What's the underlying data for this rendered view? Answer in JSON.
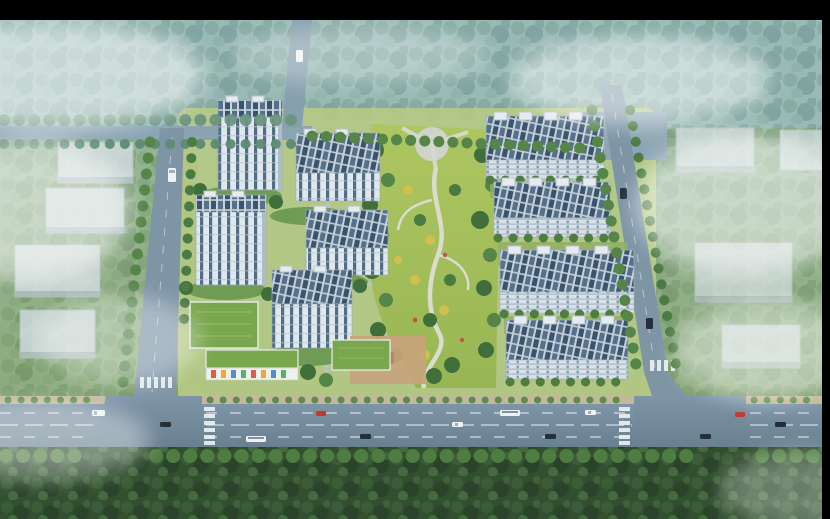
{
  "meta": {
    "subject": "Aerial architectural rendering of a residential community master plan",
    "view": "bird's-eye perspective with atmospheric fog, no text or UI elements",
    "canvas": {
      "width": 830,
      "height": 519
    },
    "letterbox": {
      "top_px": 20,
      "right_px": 8,
      "color": "#000000"
    }
  },
  "palette": {
    "letterbox": "#000000",
    "haze_sky": "#a4c3c9",
    "haze_mid": "#93b2a4",
    "ground_green": "#88a97c",
    "ground_deep": "#4e7046",
    "forest_teal": "#8fb3ac",
    "forest_dark": "#324f30",
    "lawn": "#aec661",
    "road": "#74899d",
    "road_light": "#8aa4b2",
    "sidewalk": "#c3b89e",
    "lane_marking": "#e3eaef",
    "tower_wall": "#dfe8ee",
    "tower_window": "#3b5872",
    "roof_light": "#c9d3da",
    "roof_panel": "#3a546e",
    "green_roof": "#79a64e",
    "warehouse": "#d6dfe4",
    "tree_green": "#4c7a43",
    "tree_light": "#6f9b55",
    "tree_yellow": "#d2c04e",
    "plaza_tan": "#c8a37c",
    "path": "#dadcd0",
    "fog": "#ffffff",
    "car_red": "#c03a2e",
    "car_dark": "#232f3a",
    "car_white": "#eef2f4"
  },
  "scene": {
    "west_cluster": {
      "label": "high-rise towers",
      "count": 5,
      "facade": "white with dark vertical window bands",
      "roof": "gray with solar panels"
    },
    "east_cluster": {
      "label": "mid-rise slab apartment rows",
      "count": 4,
      "facade": "light gray with horizontal floor lines",
      "roof": "gray with dark solar-panel strips and rooftop boxes"
    },
    "central_park": {
      "label": "landscaped central park",
      "features": [
        "curved plaza",
        "winding footpath",
        "lawns",
        "dark green tree clumps",
        "yellow accent trees",
        "flower beds"
      ]
    },
    "lowrise_block": {
      "label": "green-roof kindergarten and amenity buildings",
      "count": 3,
      "extras": [
        "tan playground plaza",
        "colorful facade strip"
      ]
    },
    "offsite_buildings": {
      "label": "hazy warehouse boxes outside the site",
      "left_count": 4,
      "right_count": 4
    },
    "roads": {
      "main_road": "wide boulevard across the bottom with dashed lanes, crosswalks and traffic",
      "vertical_roads": 3,
      "top_road": "tree-lined road across the upper edge with entrance plaza"
    },
    "vehicles": {
      "white": 5,
      "dark": 7,
      "red": 2,
      "bus": 2
    },
    "vegetation": [
      "dense teal forest band across the top",
      "dark forest band across the bottom",
      "street tree rows along all roads",
      "courtyard gardens"
    ],
    "atmosphere": [
      "white fog patches over corners, left warehouses and right side"
    ]
  }
}
